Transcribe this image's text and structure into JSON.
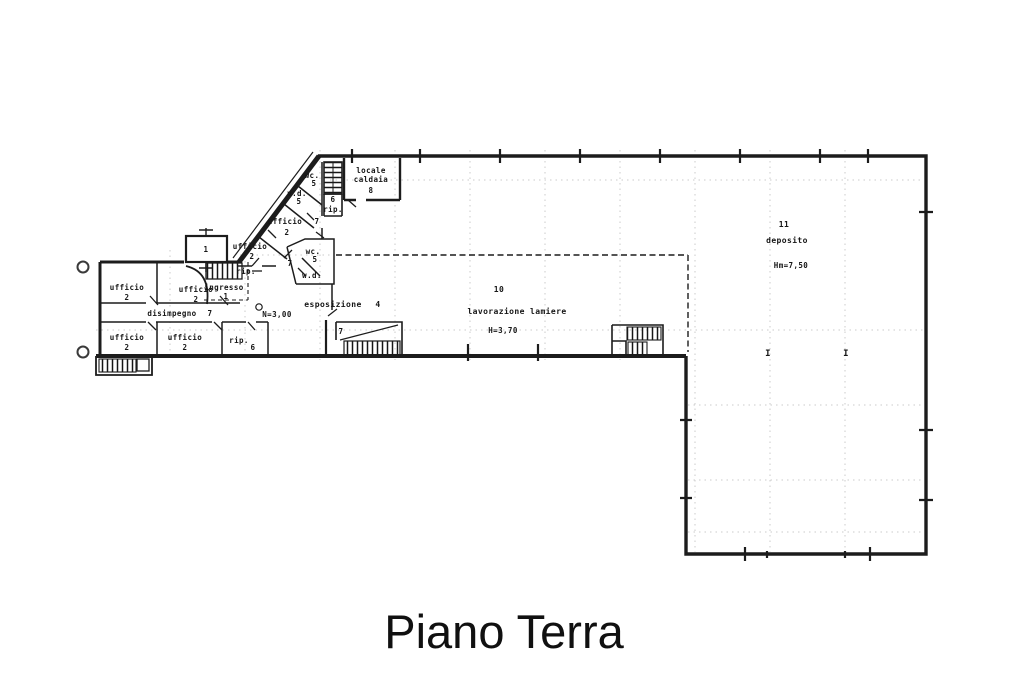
{
  "title": {
    "text": "Piano Terra"
  },
  "colors": {
    "ink": "#1c1c1c",
    "grid": "#b0b0b0",
    "paper": "#ffffff"
  },
  "plan": {
    "left_wing": {
      "office_top_left": {
        "name": "ufficio",
        "num": "2"
      },
      "office_top_mid": {
        "name": "ufficio",
        "num": "2"
      },
      "hallway": {
        "name": "disimpegno",
        "num": "7"
      },
      "office_bottom_left": {
        "name": "ufficio",
        "num": "2"
      },
      "office_bottom_mid": {
        "name": "ufficio",
        "num": "2"
      },
      "storage": {
        "name": "rip.",
        "num": "6"
      }
    },
    "entrance": {
      "box_num": "1",
      "vestibule": {
        "name": "ingresso",
        "num": "1"
      },
      "storage": {
        "name": "rip."
      }
    },
    "diagonal_wing": {
      "office_lower": {
        "name": "ufficio",
        "num": "2"
      },
      "office_upper": {
        "name": "ufficio",
        "num": "2"
      },
      "corridor_upper_num": "7",
      "wc_upper": {
        "name": "wc.",
        "num": "5"
      },
      "service_upper": {
        "name": "v.d.",
        "num": "5"
      },
      "wc_lower": {
        "name": "wc.",
        "num": "5"
      },
      "corridor_lower_num": "7",
      "service_lower": {
        "name": "w.d."
      },
      "stair_num": "6",
      "stair_storage": {
        "name": "rip."
      },
      "boiler_room": {
        "line1": "locale",
        "line2": "caldaia",
        "num": "8"
      }
    },
    "showroom": {
      "name": "esposizione",
      "num": "4",
      "height": "N=3,00",
      "stair_num": "7"
    },
    "workshop": {
      "num": "10",
      "name": "lavorazione lamiere",
      "height": "H=3,70"
    },
    "warehouse": {
      "num": "11",
      "name": "deposito",
      "height": "Hm=7,50",
      "col_mark_a": "I",
      "col_mark_b": "I"
    }
  }
}
